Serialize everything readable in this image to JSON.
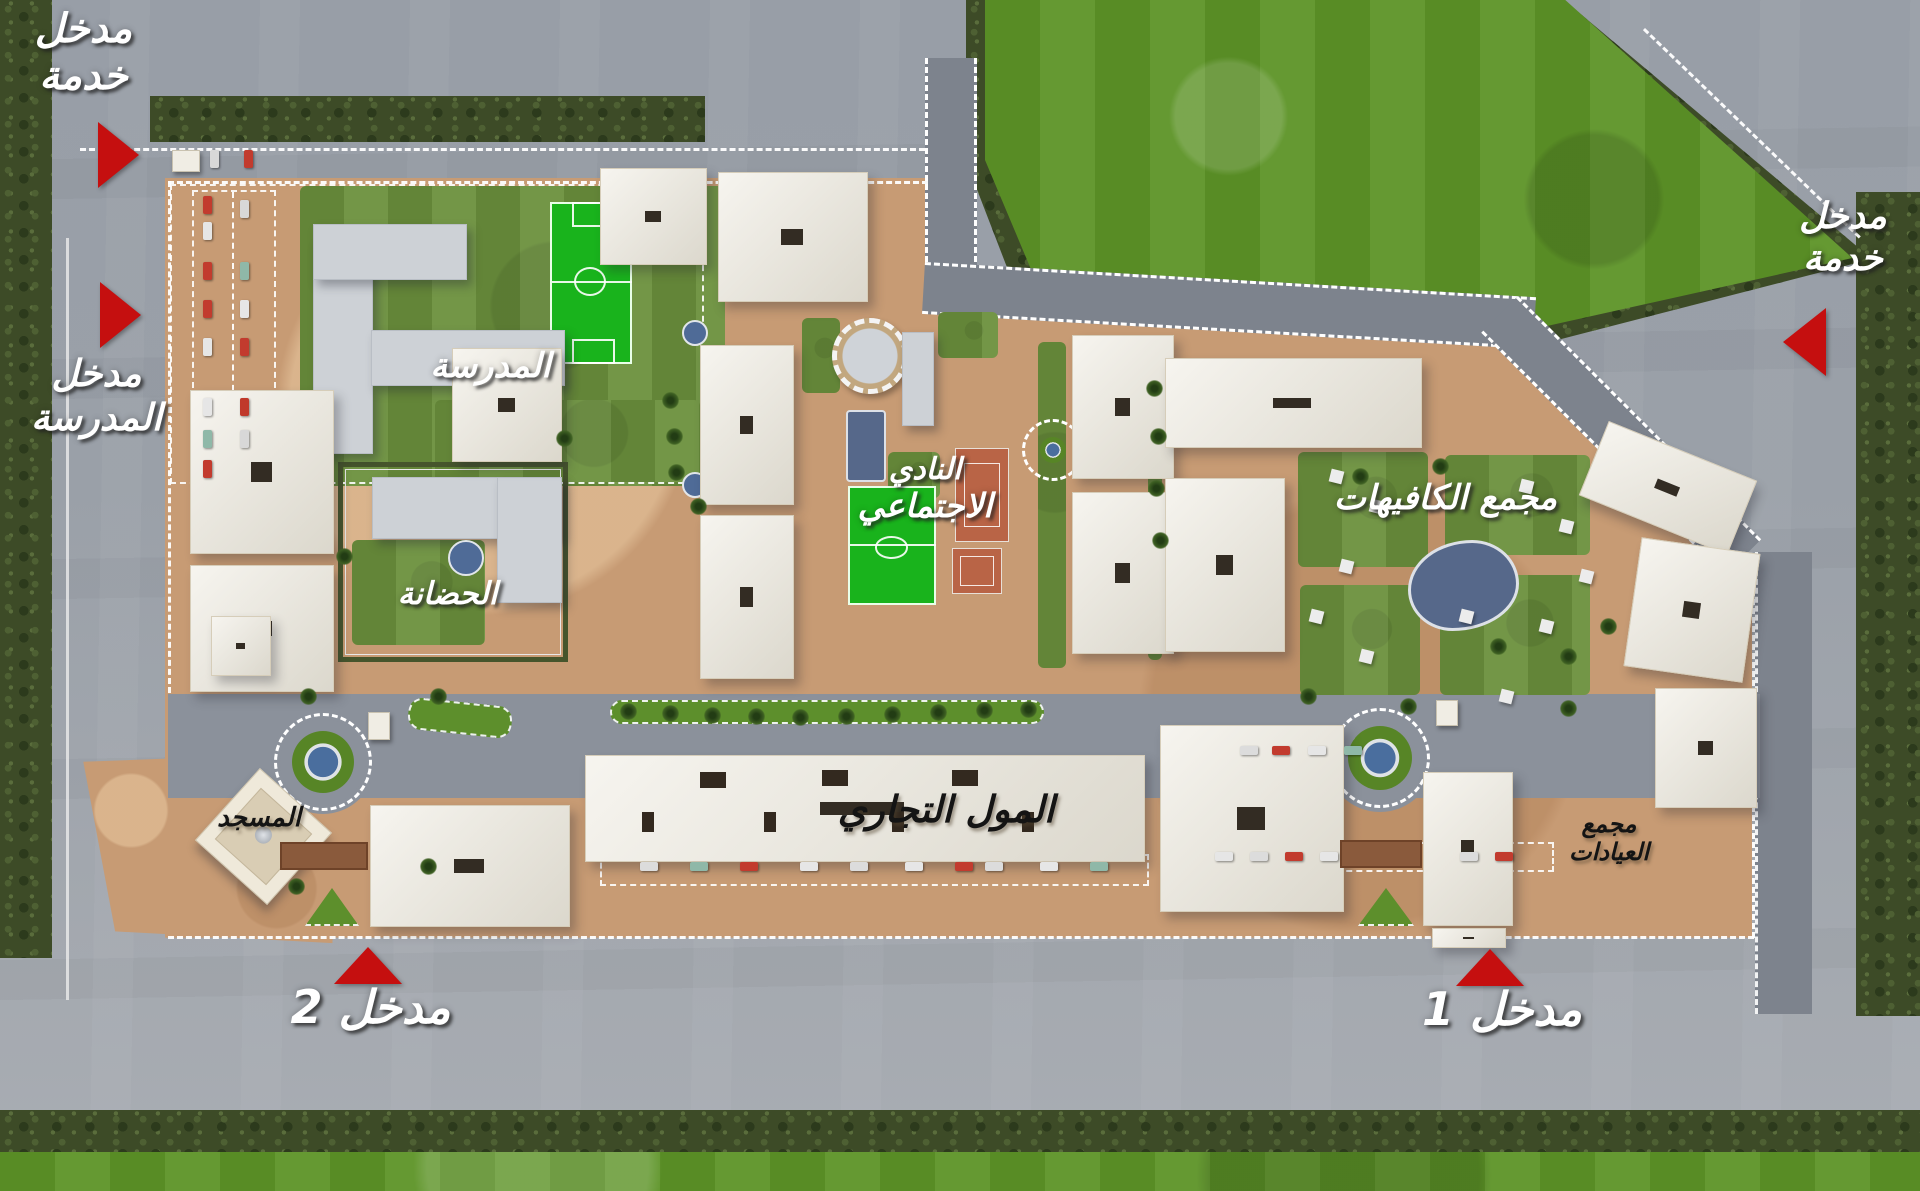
{
  "palette": {
    "asphalt": "#9aa0a8",
    "asphalt_dark": "#7d838d",
    "ground_tan": "#c79b74",
    "building_cream": "#ece8dc",
    "building_gray": "#cdd1d6",
    "grass_field": "#5d9427",
    "hedge_dark": "#3d4b27",
    "pitch_green": "#19b31c",
    "pool_blue": "#56688a",
    "clay_court": "#b96446",
    "marker_red": "#c50f0f",
    "label_white": "#ffffff",
    "label_dark": "#141414"
  },
  "labels": {
    "service_entrance_top": {
      "line1": "مدخل",
      "line2": "خدمة"
    },
    "school_entrance": {
      "line1": "مدخل",
      "line2": "المدرسة"
    },
    "school": "المدرسة",
    "nursery": "الحضانة",
    "social_club": {
      "line1": "النادي",
      "line2": "الاجتماعي"
    },
    "cafes_complex": "مجمع الكافيهات",
    "commercial_mall": "المول التجاري",
    "mosque": "المسجد",
    "clinics_complex": {
      "line1": "مجمع",
      "line2": "العيادات"
    },
    "entrance_1": "مدخل 1",
    "entrance_2": "مدخل 2",
    "service_entrance_right": {
      "line1": "مدخل",
      "line2": "خدمة"
    }
  },
  "markers": {
    "service_entrance_top_arrows": "right",
    "school_entrance_arrow": "right",
    "service_entrance_right_arrow": "left",
    "entrance_1_arrow": "up",
    "entrance_2_arrow": "up"
  }
}
